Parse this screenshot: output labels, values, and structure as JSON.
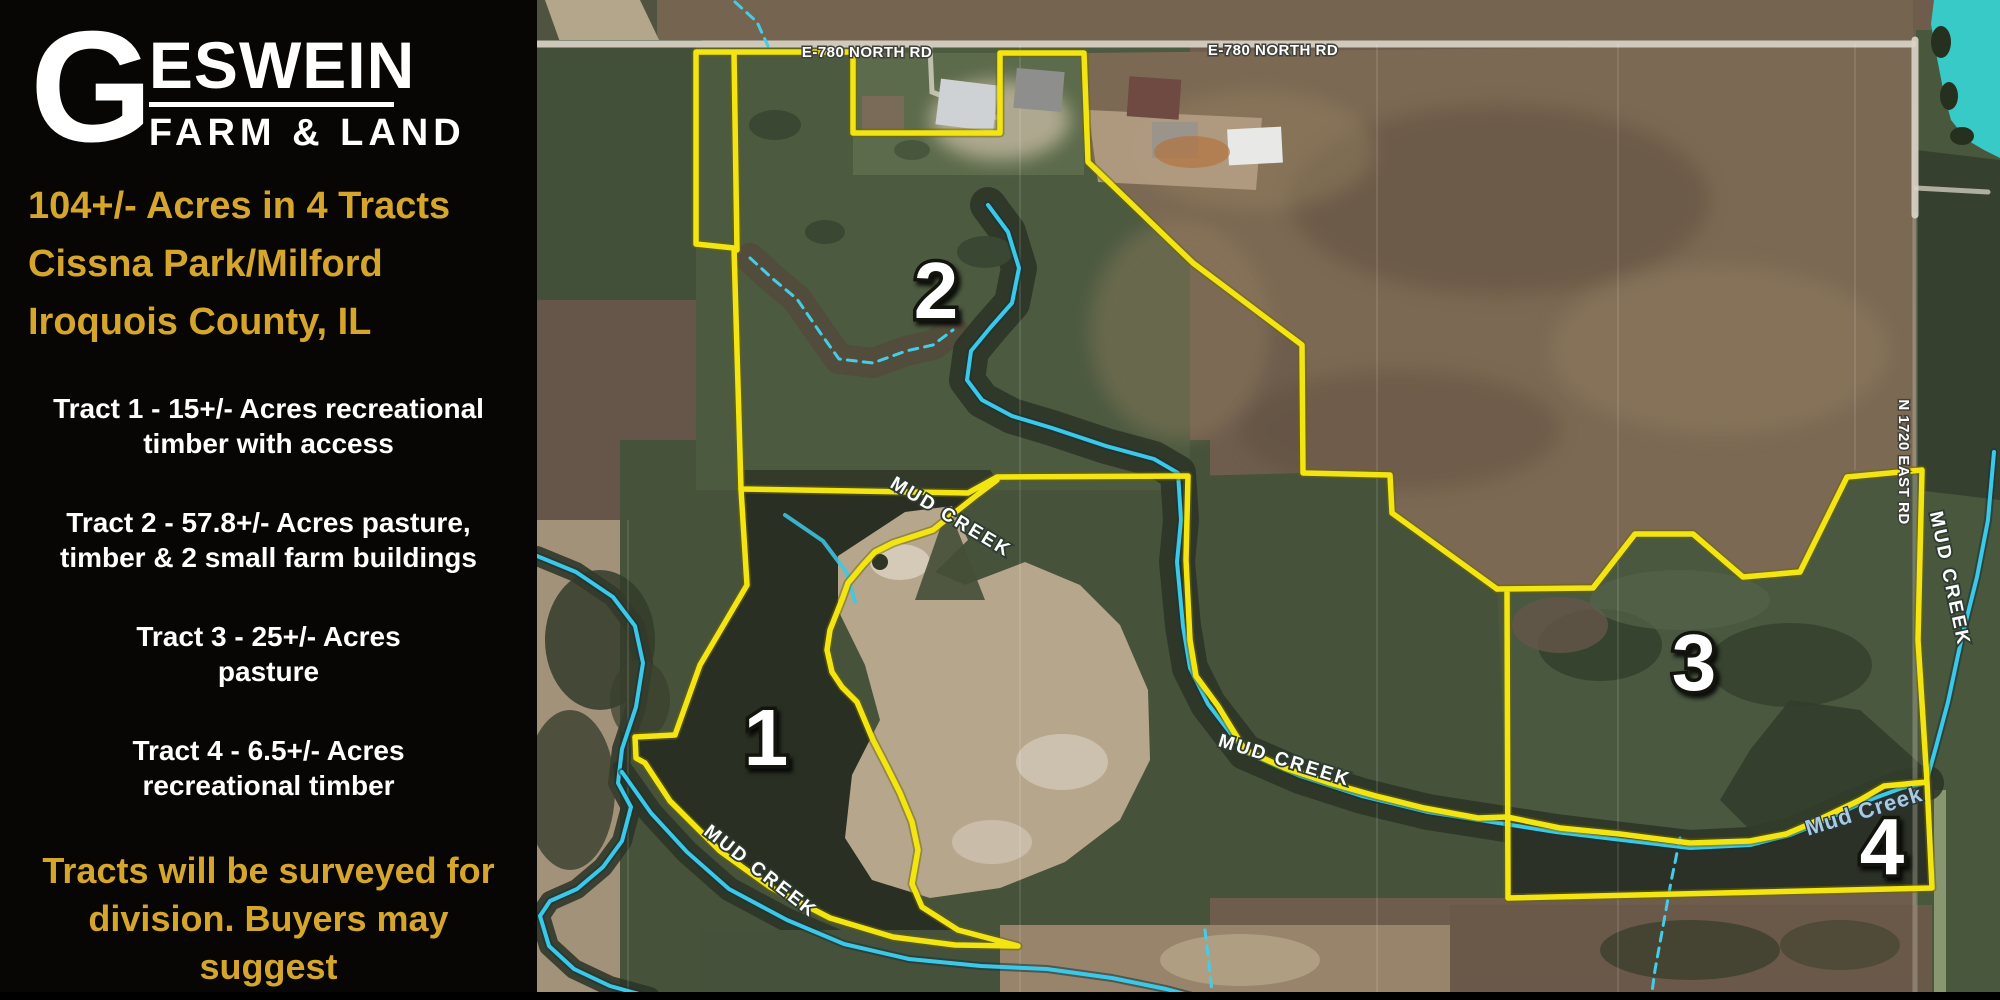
{
  "sidebar": {
    "logo": {
      "g": "G",
      "name": "ESWEIN",
      "tagline": "FARM & LAND"
    },
    "headline_lines": [
      "104+/- Acres in 4 Tracts",
      "Cissna Park/Milford",
      "Iroquois County, IL"
    ],
    "tracts": [
      {
        "line1": "Tract 1 - 15+/- Acres recreational",
        "line2": "timber with access"
      },
      {
        "line1": "Tract 2 - 57.8+/- Acres pasture,",
        "line2": "timber & 2 small farm buildings"
      },
      {
        "line1": "Tract 3 - 25+/- Acres",
        "line2": "pasture"
      },
      {
        "line1": "Tract 4 - 6.5+/- Acres",
        "line2": "recreational timber"
      }
    ],
    "note_lines": [
      "Tracts will be surveyed for",
      "division.  Buyers may",
      "suggest",
      "tract shape with offers."
    ]
  },
  "map": {
    "colors": {
      "boundary": "#f3e512",
      "creek": "#3cc9e8",
      "pond": "#38cac6",
      "accent_gold": "#d5a62b"
    },
    "labels": [
      {
        "name": "road-label-e780-west",
        "text": "E-780 NORTH RD",
        "x": 867,
        "y": 57,
        "rot": 0,
        "cls": "road"
      },
      {
        "name": "road-label-e780-east",
        "text": "E-780 NORTH RD",
        "x": 1273,
        "y": 55,
        "rot": 0,
        "cls": "road"
      },
      {
        "name": "road-label-n1720-east-rd",
        "text": "N 1720 EAST RD",
        "x": 1899,
        "y": 462,
        "rot": 90,
        "cls": "road"
      },
      {
        "name": "creek-label-upper",
        "text": "MUD CREEK",
        "x": 948,
        "y": 522,
        "rot": 31,
        "cls": "creek"
      },
      {
        "name": "creek-label-tract1",
        "text": "MUD CREEK",
        "x": 757,
        "y": 876,
        "rot": 38,
        "cls": "creek"
      },
      {
        "name": "creek-label-tract3",
        "text": "MUD CREEK",
        "x": 1283,
        "y": 766,
        "rot": 17,
        "cls": "creek"
      },
      {
        "name": "creek-label-east",
        "text": "MUD CREEK",
        "x": 1944,
        "y": 580,
        "rot": 78,
        "cls": "creek"
      },
      {
        "name": "creek-label-tract4",
        "text": "Mud Creek",
        "x": 1866,
        "y": 818,
        "rot": -17,
        "cls": "creek-blue"
      },
      {
        "name": "tract-number-1",
        "text": "1",
        "x": 766,
        "y": 765,
        "rot": 0,
        "cls": "tract-num"
      },
      {
        "name": "tract-number-2",
        "text": "2",
        "x": 936,
        "y": 318,
        "rot": 0,
        "cls": "tract-num"
      },
      {
        "name": "tract-number-3",
        "text": "3",
        "x": 1694,
        "y": 690,
        "rot": 0,
        "cls": "tract-num"
      },
      {
        "name": "tract-number-4",
        "text": "4",
        "x": 1882,
        "y": 874,
        "rot": 0,
        "cls": "tract-num"
      }
    ]
  }
}
